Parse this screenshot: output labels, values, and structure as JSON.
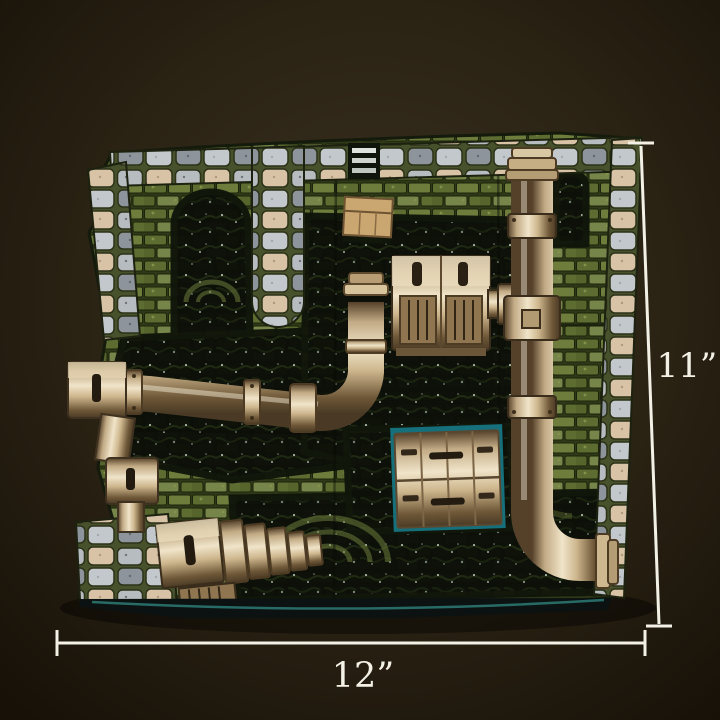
{
  "annotations": {
    "height_label": "11”",
    "width_label": "12”"
  },
  "colors": {
    "background_center": "#3a3120",
    "background_edge": "#171108",
    "dimension_line": "#f3f0e6",
    "label_text": "#f3f0e6",
    "pipe_bronze": "#c9b288",
    "moss_green": "#66752f",
    "water_dark": "#0b0f08",
    "cobble_gray": "#b7bcc0",
    "cobble_tan": "#d9c3a6",
    "water_edge_teal": "#2e7a74"
  }
}
